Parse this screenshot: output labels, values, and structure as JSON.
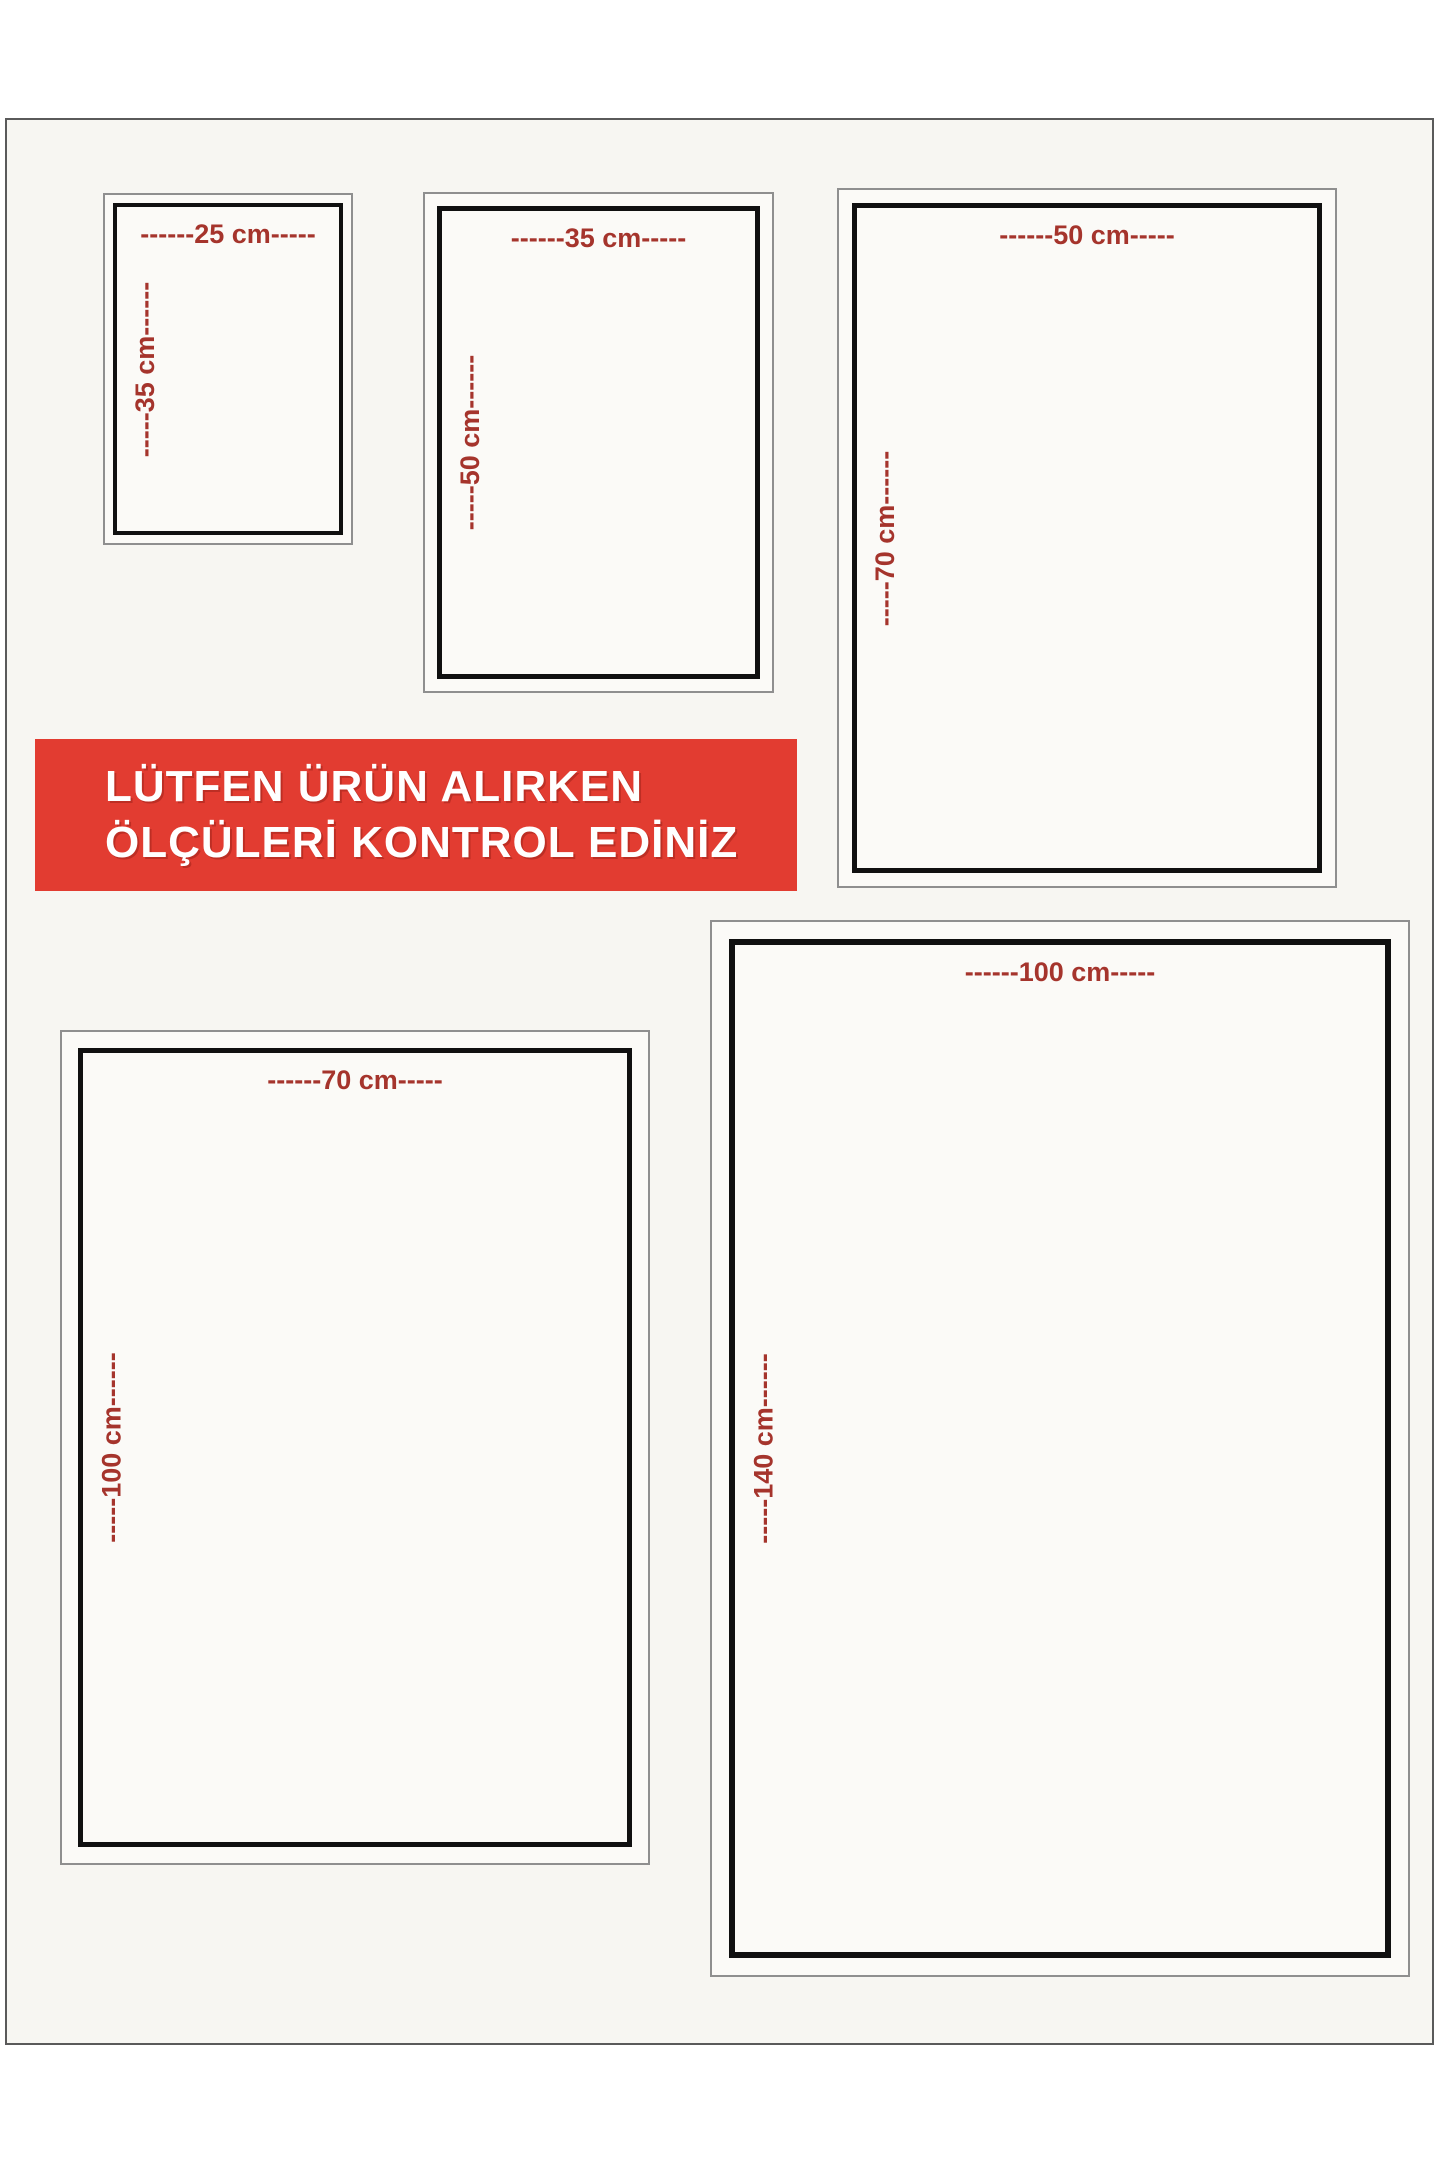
{
  "banner": {
    "line1": "LÜTFEN ÜRÜN ALIRKEN",
    "line2": "ÖLÇÜLERİ KONTROL EDİNİZ"
  },
  "colors": {
    "dimension_label": "#a5342c",
    "banner_bg": "#e23c31",
    "banner_text": "#ffffff",
    "box_border": "#101010",
    "box_outer_border": "#8f8f8f",
    "page_border": "#5a5a5a",
    "page_bg": "#f7f6f2"
  },
  "sizes": [
    {
      "width_cm": 25,
      "height_cm": 35,
      "width_label": "------25 cm-----",
      "height_label": "-----35 cm------"
    },
    {
      "width_cm": 35,
      "height_cm": 50,
      "width_label": "------35 cm-----",
      "height_label": "-----50 cm------"
    },
    {
      "width_cm": 50,
      "height_cm": 70,
      "width_label": "------50 cm-----",
      "height_label": "-----70 cm------"
    },
    {
      "width_cm": 70,
      "height_cm": 100,
      "width_label": "------70 cm-----",
      "height_label": "-----100 cm------"
    },
    {
      "width_cm": 100,
      "height_cm": 140,
      "width_label": "------100 cm-----",
      "height_label": "-----140 cm------"
    }
  ]
}
